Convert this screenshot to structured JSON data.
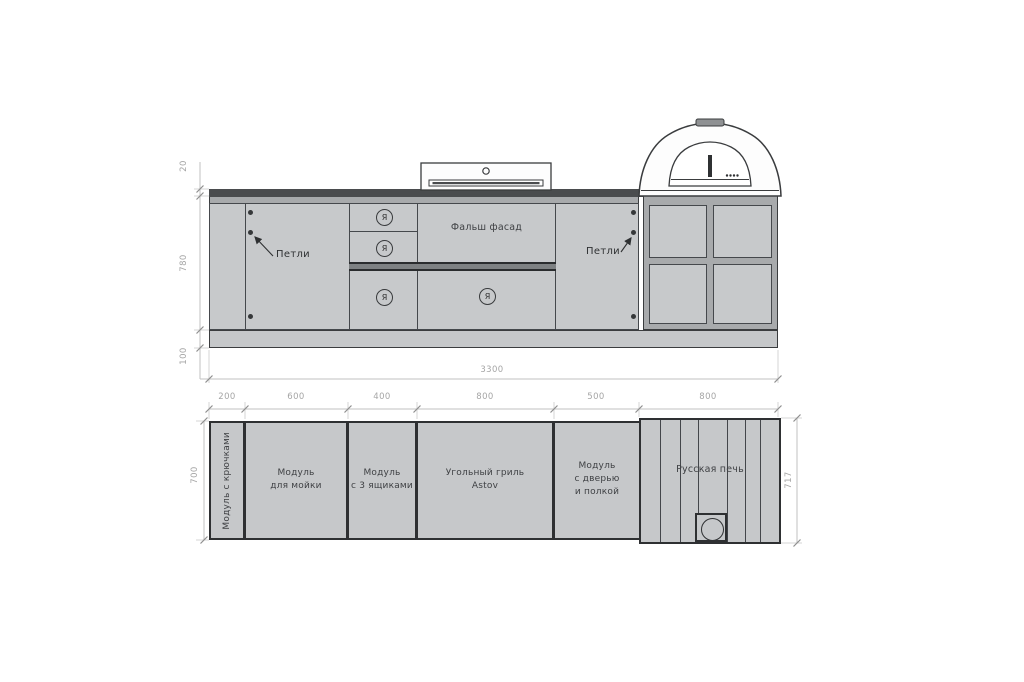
{
  "elevation": {
    "dim_countertop": "20",
    "dim_cabinet_height": "780",
    "dim_plinth": "100",
    "dim_total_width": "3300",
    "hinges_label_left": "Петли",
    "hinges_label_right": "Петли",
    "false_facade_label": "Фальш фасад",
    "drawer_symbol": "Я"
  },
  "plan": {
    "top_dims": [
      "200",
      "600",
      "400",
      "800",
      "500",
      "800"
    ],
    "depth_left": "700",
    "depth_right": "717",
    "modules": [
      {
        "label": "Модуль с крючками"
      },
      {
        "label": "Модуль\nдля мойки"
      },
      {
        "label": "Модуль\nс 3 ящиками"
      },
      {
        "label": "Угольный гриль\nAstov"
      },
      {
        "label": "Модуль\nс дверью\nи полкой"
      },
      {
        "label": "Русская печь"
      }
    ]
  },
  "colors": {
    "module_fill": "#c7c9cb",
    "countertop": "#4a4c4e",
    "outline": "#3a3c3e",
    "dimension_text": "#a5a5a5"
  }
}
